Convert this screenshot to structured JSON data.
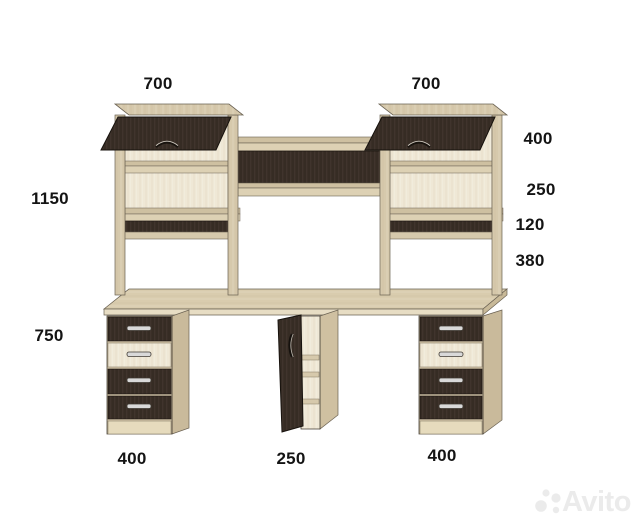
{
  "diagram_type": "furniture-dimension-drawing",
  "dims": {
    "top_left_width": "700",
    "top_right_width": "700",
    "left_total_height": "1150",
    "right_top_height": "400",
    "right_opening_height": "250",
    "right_niche_height": "120",
    "right_clearance_height": "380",
    "desk_height": "750",
    "bottom_left_width": "400",
    "bottom_center_width": "250",
    "bottom_right_width": "400"
  },
  "watermark": {
    "brand": "Avito"
  },
  "colors": {
    "background": "#ffffff",
    "light_wood": "#d6c9ac",
    "cream_wood": "#efe8d6",
    "dark_wood": "#3a2f27",
    "label_text": "#141414",
    "watermark": "#ebebeb"
  }
}
